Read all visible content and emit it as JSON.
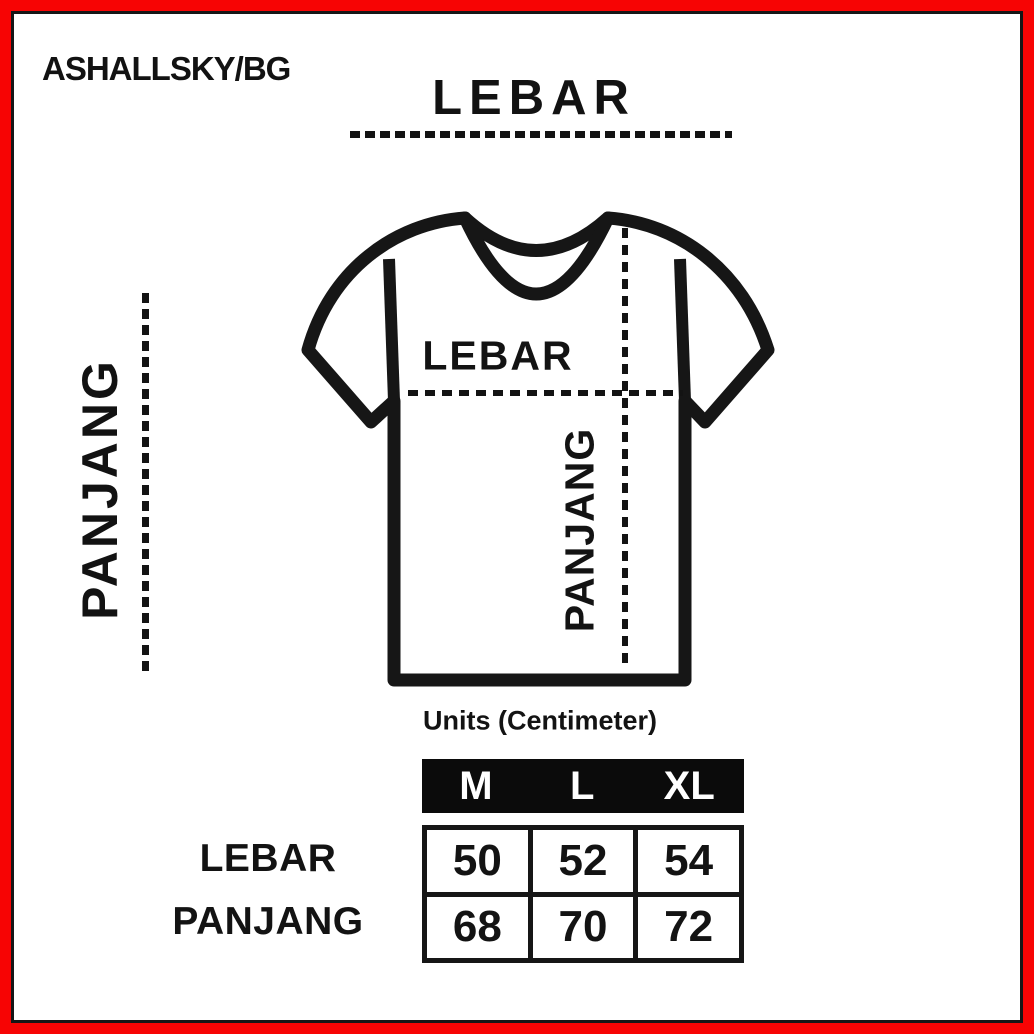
{
  "brand": "ASHALLSKY/BG",
  "diagram": {
    "top_width_label": "LEBAR",
    "side_length_label": "PANJANG",
    "inner_width_label": "LEBAR",
    "inner_length_label": "PANJANG"
  },
  "units_note": "Units (Centimeter)",
  "size_table": {
    "columns": [
      "M",
      "L",
      "XL"
    ],
    "rows": [
      {
        "label": "LEBAR",
        "values": [
          50,
          52,
          54
        ]
      },
      {
        "label": "PANJANG",
        "values": [
          68,
          70,
          72
        ]
      }
    ]
  },
  "colors": {
    "frame_red": "#f70404",
    "ink_black": "#161616",
    "table_header_bg": "#0b0b0b",
    "table_header_text": "#ffffff"
  }
}
